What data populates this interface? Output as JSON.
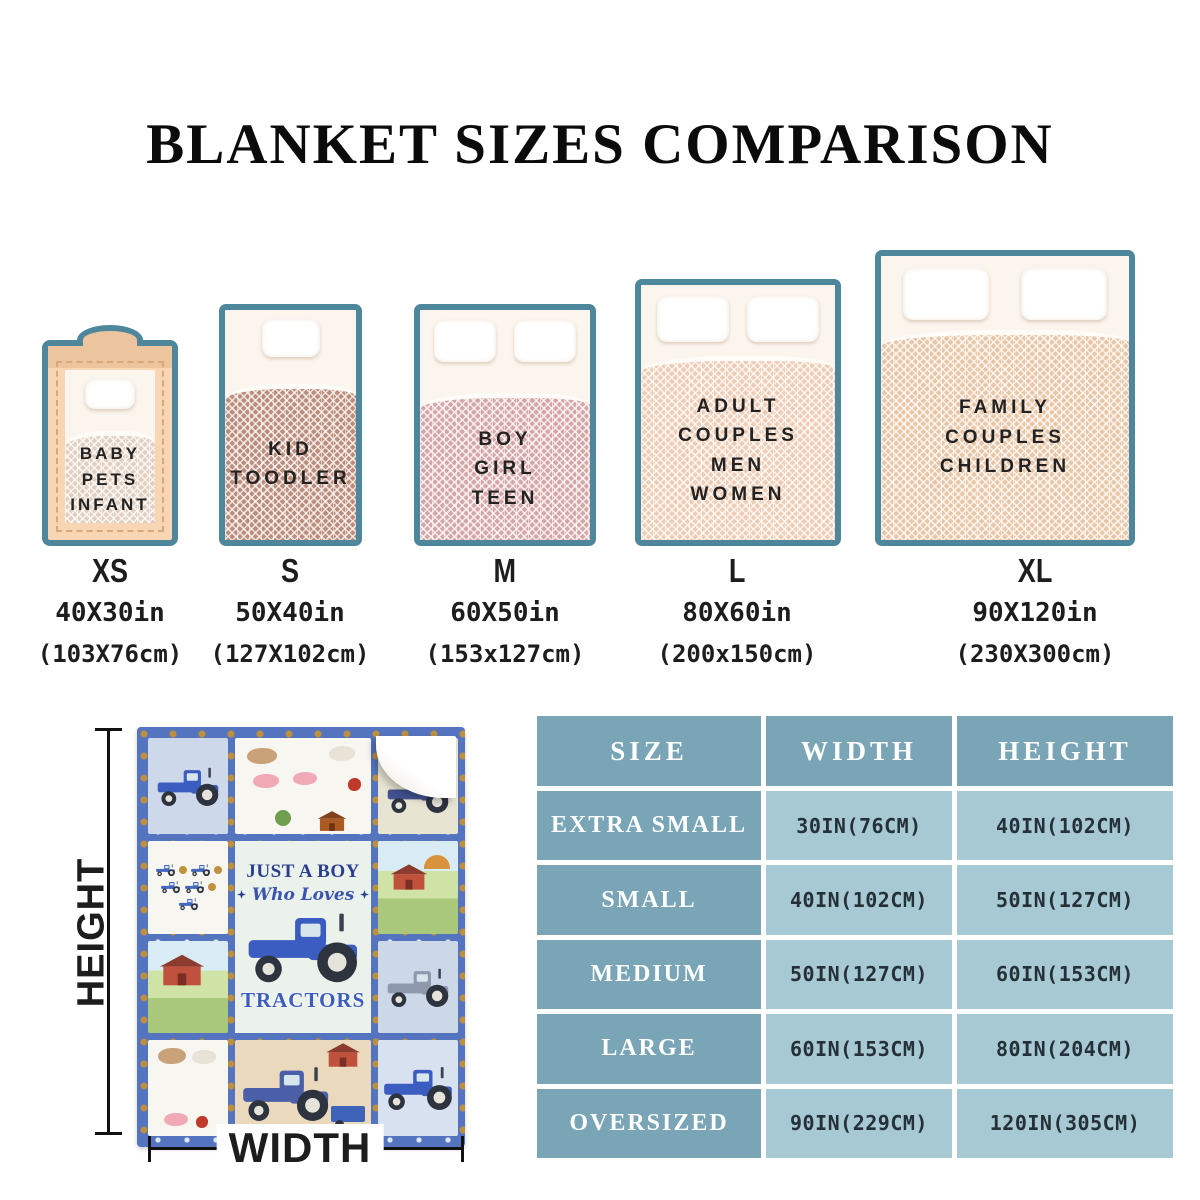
{
  "title": "BLANKET SIZES COMPARISON",
  "beds": [
    {
      "code": "XS",
      "audience": [
        "BABY",
        "PETS",
        "INFANT"
      ],
      "inches": "40X30in",
      "cm": "(103X76cm)"
    },
    {
      "code": "S",
      "audience": [
        "KID",
        "TOODLER"
      ],
      "inches": "50X40in",
      "cm": "(127X102cm)"
    },
    {
      "code": "M",
      "audience": [
        "BOY",
        "GIRL",
        "TEEN"
      ],
      "inches": "60X50in",
      "cm": "(153x127cm)"
    },
    {
      "code": "L",
      "audience": [
        "ADULT",
        "COUPLES",
        "MEN",
        "WOMEN"
      ],
      "inches": "80X60in",
      "cm": "(200x150cm)"
    },
    {
      "code": "XL",
      "audience": [
        "FAMILY",
        "COUPLES",
        "CHILDREN"
      ],
      "inches": "90X120in",
      "cm": "(230X300cm)"
    }
  ],
  "product": {
    "line1": "JUST A BOY",
    "line2": "Who Loves",
    "line3": "TRACTORS",
    "height_label": "HEIGHT",
    "width_label": "WIDTH"
  },
  "size_table": {
    "headers": [
      "SIZE",
      "WIDTH",
      "HEIGHT"
    ],
    "rows": [
      {
        "size": "EXTRA SMALL",
        "width": "30IN(76CM)",
        "height": "40IN(102CM)"
      },
      {
        "size": "SMALL",
        "width": "40IN(102CM)",
        "height": "50IN(127CM)"
      },
      {
        "size": "MEDIUM",
        "width": "50IN(127CM)",
        "height": "60IN(153CM)"
      },
      {
        "size": "LARGE",
        "width": "60IN(153CM)",
        "height": "80IN(204CM)"
      },
      {
        "size": "OVERSIZED",
        "width": "90IN(229CM)",
        "height": "120IN(305CM)"
      }
    ]
  },
  "colors": {
    "bed_border_teal": "#4e869c",
    "table_header_blue": "#79a5b6",
    "table_cell_blue": "#a7c9d4",
    "blanket_border_blue": "#5474bf",
    "text_navy": "#2b3f8f",
    "xs_crib_tan": "#f8d6b3",
    "s_blanket": "#bd8d7c",
    "m_blanket": "#d6a6a6",
    "l_blanket": "#efccb4",
    "xl_blanket": "#e9c6a6"
  }
}
